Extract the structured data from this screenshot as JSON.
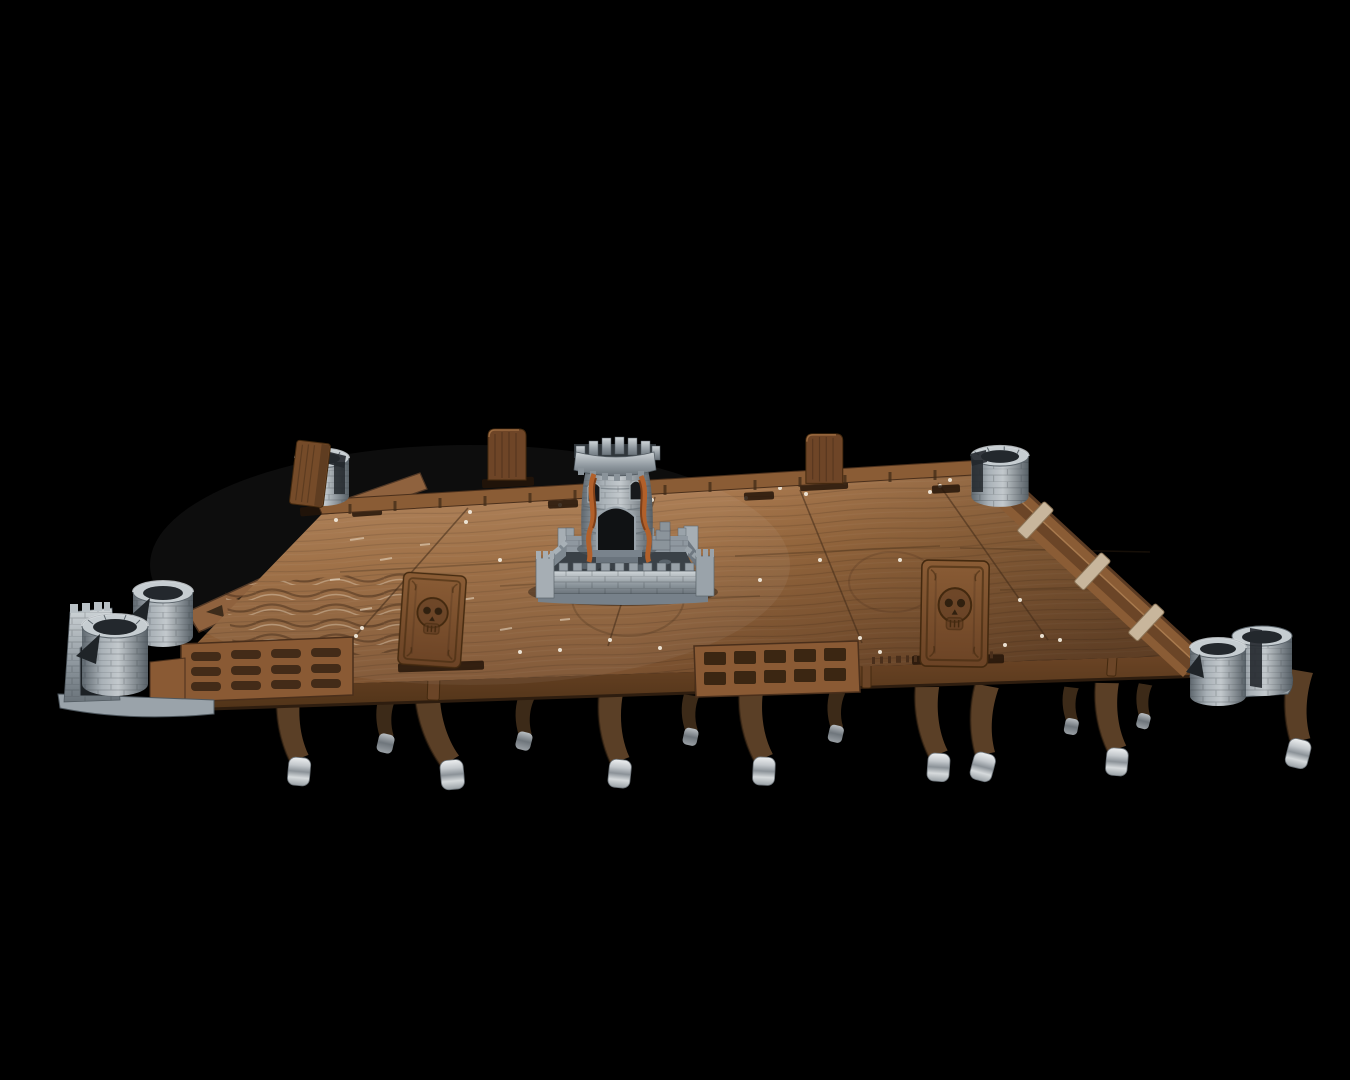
{
  "image": {
    "type": "product-photo",
    "subject": "Modular wooden tabletop gaming table on a black background, with a central stone castle dice tower, stone tower cup holders on the corners, carved skull panels, upright divider panels, slotted edge rails and curved wooden legs with steel caps",
    "background": "black"
  },
  "objects": {
    "table": "wooden gaming table",
    "dice_tower": "central castle dice tower with crenellated turret, arched door and windows, rust-colored roots",
    "dice_tower_courtyard": "crenellated stone courtyard platform",
    "cup_holder_top_left": "stone tower cup holder, top-left corner",
    "cup_holder_top_right": "stone tower cup holder, top-right corner",
    "cup_holder_bottom_right": "double stone tower cup holder, bottom-right corner",
    "cup_holder_cluster_left": "triple stone tower cup holder cluster with bastion, left corner",
    "skull_panel_left": "carved wooden skull relief panel (left)",
    "skull_panel_right": "carved wooden skull relief panel (right)",
    "divider_panels": "upright wooden divider panels slotted into the far rail",
    "leaning_panel": "wooden panel leaning at the top-left corner",
    "edge_rails": "modular wooden edge rails with slots and weathered cross bars",
    "front_trays": "slotted organizer trays on the front rail",
    "legs": "curved wooden legs with brushed steel caps"
  },
  "counts": {
    "legs_visible": 14,
    "cup_holder_towers": 7,
    "divider_panels": 3,
    "skull_panels": 2
  },
  "colors": {
    "bg": "#000000",
    "wood_hi": "#b8895a",
    "wood_mid": "#9a6a3f",
    "wood_dark": "#7d5130",
    "wood_deep": "#4a2f1b",
    "rail_wood": "#8a5a34",
    "panel_wood": "#7a4e2c",
    "leg_wood": "#5a3f26",
    "leg_dark": "#3c2a18",
    "scuff": "#ecdfc8",
    "seam": "#3f2a17",
    "stone_hi": "#cfd5d8",
    "stone_mid": "#98a1a7",
    "stone_dark": "#6a737a",
    "stone_deep": "#2b3136",
    "metal_hi": "#eceeef",
    "metal_mid": "#aab1b7",
    "metal_dark": "#6e757b",
    "rust": "#b2602a",
    "rust_dark": "#7e3f18"
  }
}
